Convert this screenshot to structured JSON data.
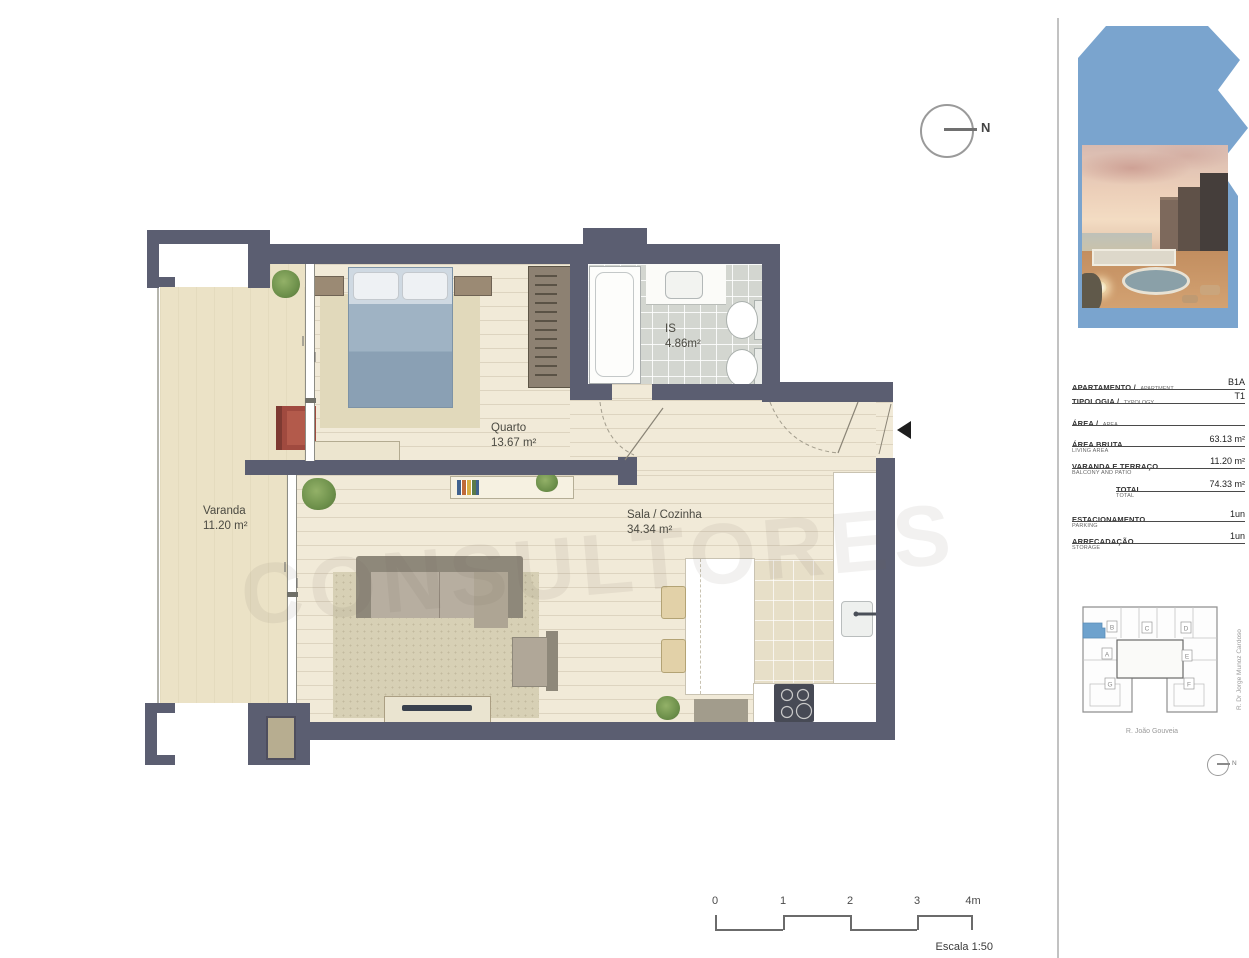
{
  "sheet": {
    "north_label": "N",
    "watermark": "CONSULTORES"
  },
  "plan": {
    "rooms": {
      "varanda": {
        "name": "Varanda",
        "area": "11.20 m²"
      },
      "quarto": {
        "name": "Quarto",
        "area": "13.67 m²"
      },
      "is": {
        "name": "IS",
        "area": "4.86m²"
      },
      "sala": {
        "name": "Sala / Cozinha",
        "area": "34.34 m²"
      }
    }
  },
  "scalebar": {
    "ticks": [
      "0",
      "1",
      "2",
      "3",
      "4m"
    ],
    "caption": "Escala 1:50"
  },
  "sidebar": {
    "table": {
      "rows": [
        {
          "label": "APARTAMENTO /",
          "en": "APARTMENT",
          "value": "B1A"
        },
        {
          "label": "TIPOLOGIA /",
          "en": "TYPOLOGY",
          "value": "T1"
        },
        {
          "label": "ÁREA /",
          "en": "AREA",
          "value": ""
        },
        {
          "label": "ÁREA BRUTA",
          "en": "LIVING AREA",
          "value": "63.13 m²"
        },
        {
          "label": "VARANDA E TERRAÇO",
          "en": "BALCONY AND PATIO",
          "value": "11.20 m²"
        },
        {
          "label": "TOTAL",
          "en": "TOTAL",
          "value": "74.33 m²"
        },
        {
          "label": "ESTACIONAMENTO",
          "en": "PARKING",
          "value": "1un"
        },
        {
          "label": "ARRECADAÇÃO",
          "en": "STORAGE",
          "value": "1un"
        }
      ]
    },
    "siteplan": {
      "units": [
        "B",
        "C",
        "D",
        "A",
        "E",
        "G",
        "F"
      ],
      "street_bottom": "R. João Gouveia",
      "street_right": "R. Dr Jorge Munoz Cardoso",
      "north_label": "N"
    }
  },
  "colors": {
    "wall": "#5b5e71",
    "logo_blue": "#7aa4ce",
    "highlight_unit": "#6ea2cd"
  }
}
